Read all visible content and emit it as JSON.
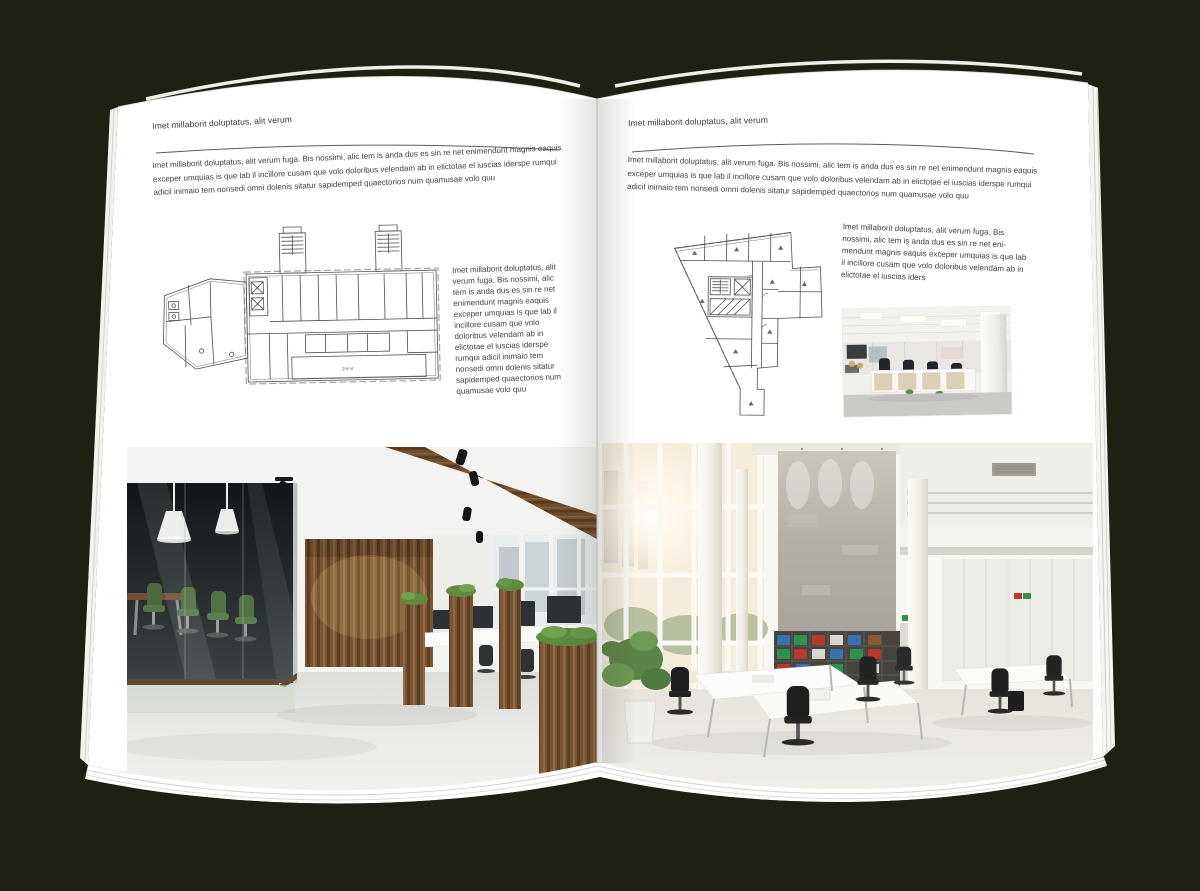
{
  "colors": {
    "background": "#201f14",
    "page": "#ffffff",
    "text": "#3e3e40",
    "rule": "#5c5c5e",
    "plan_line": "#4e4e4a",
    "wood": "#7a5634",
    "chair_green": "#4c6a3d",
    "binder_red": "#b6392f",
    "binder_green": "#2f9150",
    "binder_blue": "#3672ae"
  },
  "left_page": {
    "header": "Imet millaborit doluptatus, alit verum",
    "intro": "Imet millaborit doluptatus, alit verum fuga. Bis nossimi, alic tem is anda dus es sin re net enimendunt magnis eaquis exceper umquias is que lab il incillore cusam que volo doloribus velendam ab in elictotae el iuscias iderspe rumqui adicil inimaio tem nonsedi omni dolenis sitatur sapidemped quaectorios num quamusae volo quu",
    "side_text": "Imet millaborit doluptatus, alit verum fuga. Bis nossimi, alic tem is anda dus es sin re net enimendunt magnis eaquis exceper umquias is que lab il incillore cusam que volo doloribus velendam ab in elictotae el iuscias iderspe rumqui adicil inimaio tem nonsedi omni dolenis sitatur sapidemped quaectorios num quamusae volo quu",
    "floor_plan_label": "2-й эт",
    "floor_plan_alt": "floor plan of wide building with two stair towers",
    "photo_alt": "loft office with glass meeting room, green chairs and wooden wall"
  },
  "right_page": {
    "header": "Imet millaborit doluptatus, alit verum",
    "intro": "Imet millaborit doluptatus, alit verum fuga. Bis nossimi, alic tem is anda dus es sin re net enimendunt magnis eaquis exceper umquias is que lab il incillore cusam que volo doloribus velendam ab in elictotae el iuscias iderspe rumqui adicil inimaio tem nonsedi omni dolenis sitatur sapidemped quaectorios num quamusae volo quu",
    "side_text": "Imet millaborit doluptatus, alit verum fuga. Bis nossimi, alic tem is anda dus es sin re net eni­mendunt magnis eaquis exceper umquias is que lab il incillore cusam que volo doloribus velendam ab in elictotae el iuscias iders",
    "floor_plan_alt": "floor plan of irregular tapering building",
    "photo_small_alt": "open plan office with white cubicle desks",
    "photo_alt": "bright double-height office atrium with concrete wall and shelving"
  }
}
